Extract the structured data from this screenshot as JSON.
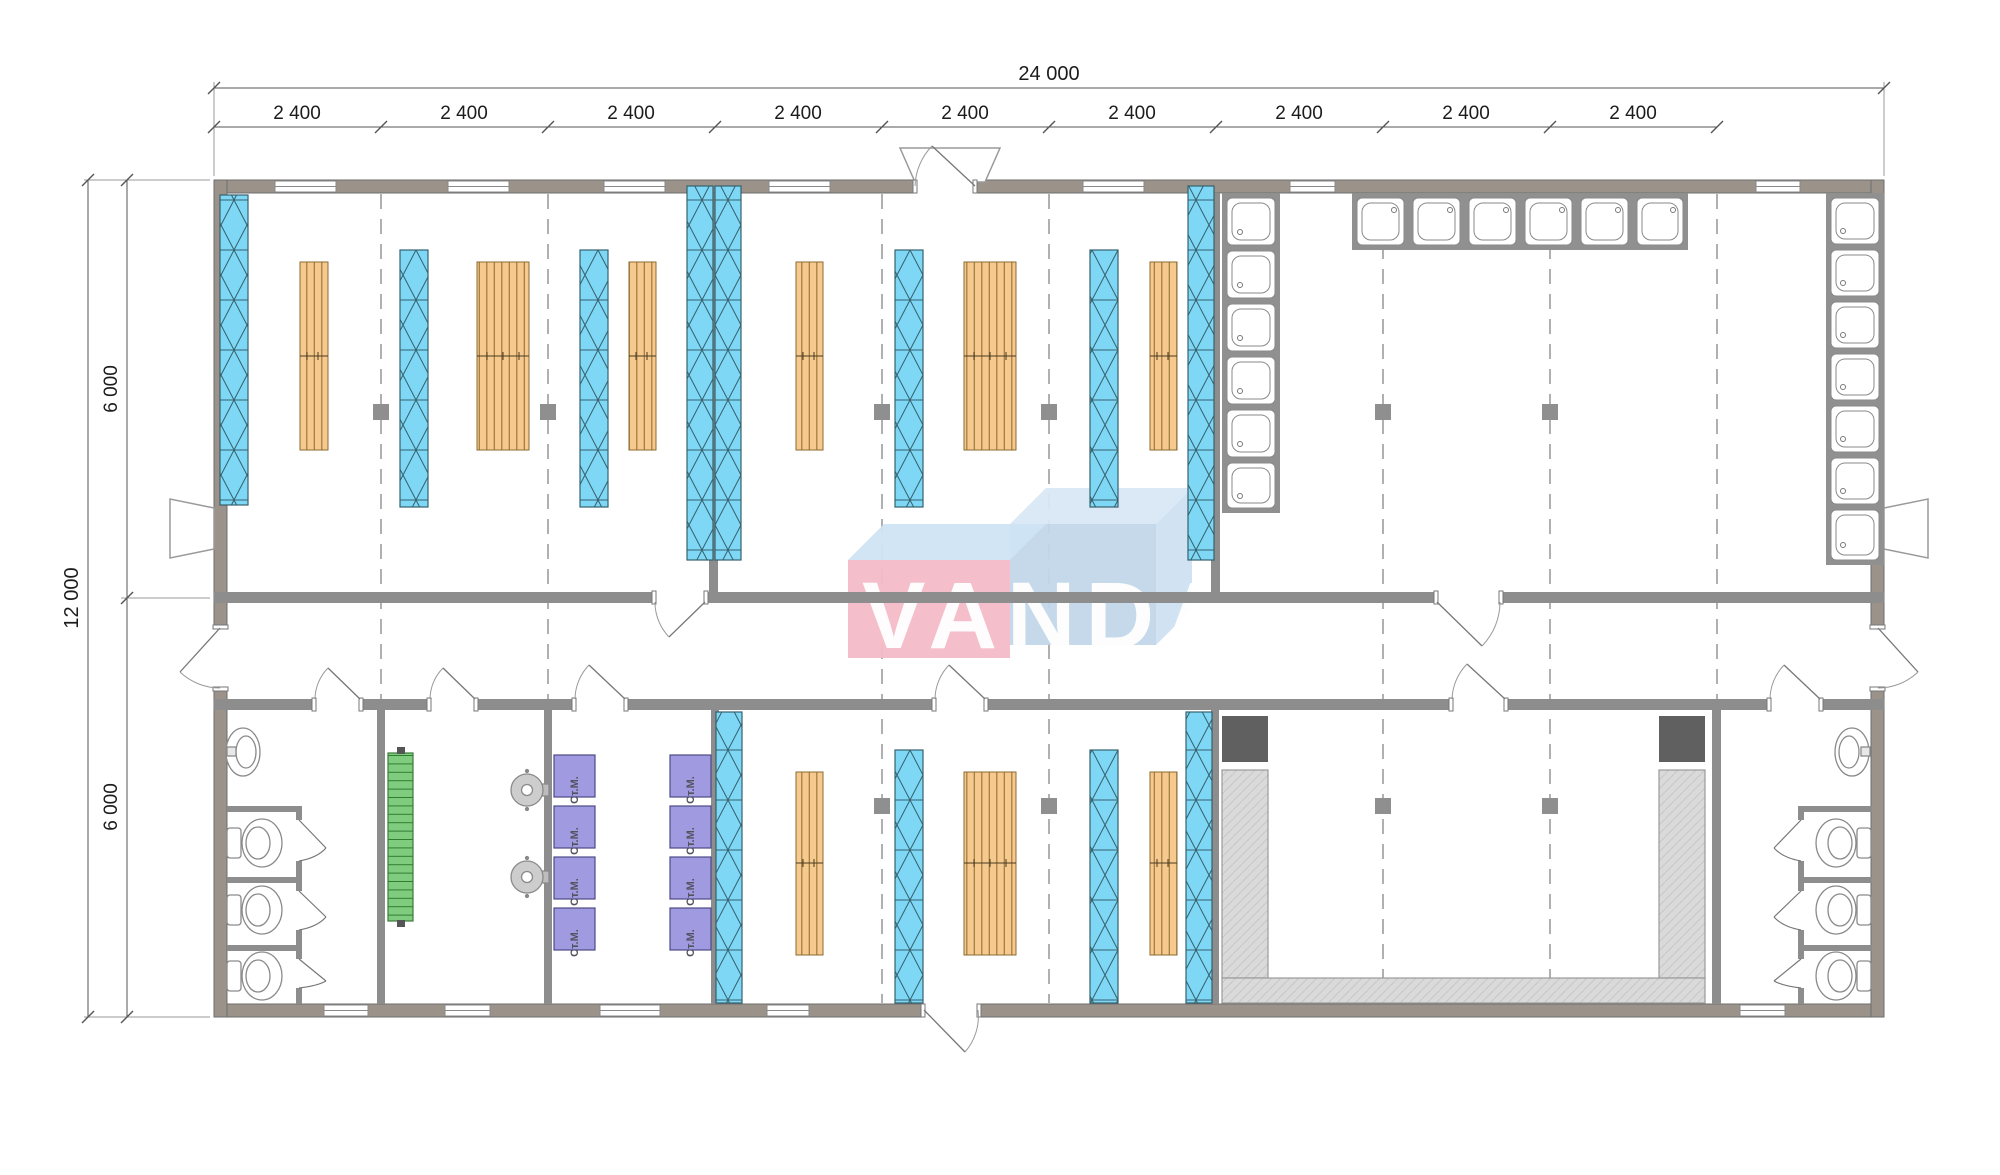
{
  "plan": {
    "type": "modular building floor plan",
    "logo_text": "VANDA",
    "dims": {
      "overall_width": "24 000",
      "overall_depth": "12 000",
      "depth_halves": [
        "6 000",
        "6 000"
      ],
      "top_modules": [
        "2 400",
        "2 400",
        "2 400",
        "2 400",
        "2 400",
        "2 400",
        "2 400",
        "2 400",
        "2 400"
      ]
    },
    "labels": {
      "washing_machine": "Ст.М."
    },
    "colors": {
      "wall_exterior": "#9b9289",
      "wall_interior": "#8d8d8d",
      "window_glass": "#7ed7f5",
      "bed_wood": "#f6c98e",
      "stairs_green": "#7fcc7f",
      "washer_purple": "#a09ae0",
      "bench_gray": "#dadada",
      "logo_pink": "#f3bac7",
      "logo_blue": "#c2d7ea"
    }
  }
}
